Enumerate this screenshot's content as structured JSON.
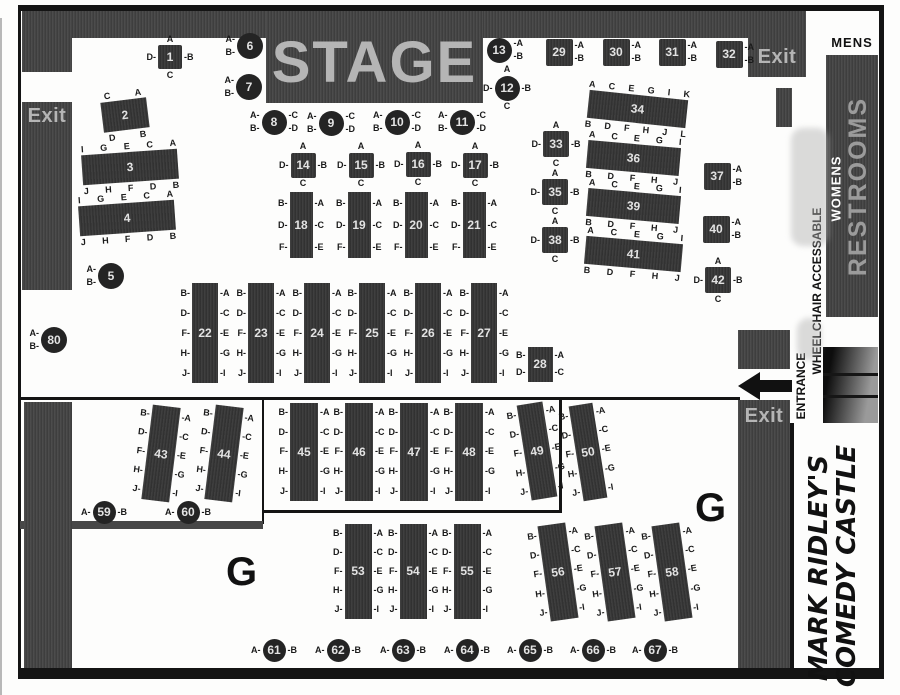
{
  "labels": {
    "stage": "STAGE",
    "exit": "Exit",
    "mens": "MENS",
    "restrooms": "RESTROOMS",
    "womens": "WOMENS",
    "entrance": "ENTRANCE",
    "wheelchair": "WHEELCHAIR ACCESSABLE",
    "g": "G",
    "logo_line1": "MARK RIDLEY'S",
    "logo_line2": "COMEDY CASTLE"
  },
  "icons": {
    "entrance_arrow": "left-arrow"
  },
  "colors": {
    "wall": "#434343",
    "table_bar": "#373737",
    "table_circle": "#242424",
    "line": "#141414",
    "stage_text": "#b5b5b5",
    "exit_text": "#b5b5b5",
    "restrooms_text": "#9b9b9b",
    "womens_text": "#ffffff",
    "seat_text": "#1a1a1a",
    "floor": "#fdfdfc"
  },
  "tables": [
    {
      "n": "1",
      "sh": "sq",
      "x": 170,
      "y": 57,
      "w": 24,
      "h": 24,
      "rot": 0,
      "T": [
        "A"
      ],
      "L": [
        "D-"
      ],
      "R": [
        "-B"
      ],
      "B": [
        "C"
      ]
    },
    {
      "n": "2",
      "sh": "bar",
      "x": 125,
      "y": 115,
      "w": 46,
      "h": 30,
      "rot": -7,
      "T": [
        "C",
        "A"
      ],
      "L": [],
      "R": [],
      "B": [
        "D",
        "B"
      ]
    },
    {
      "n": "3",
      "sh": "bar",
      "x": 130,
      "y": 167,
      "w": 96,
      "h": 30,
      "rot": -4,
      "T": [
        "I",
        "G",
        "E",
        "C",
        "A"
      ],
      "L": [],
      "R": [],
      "B": [
        "J",
        "H",
        "F",
        "D",
        "B"
      ]
    },
    {
      "n": "4",
      "sh": "bar",
      "x": 127,
      "y": 218,
      "w": 96,
      "h": 30,
      "rot": -4,
      "T": [
        "I",
        "G",
        "E",
        "C",
        "A"
      ],
      "L": [],
      "R": [],
      "B": [
        "J",
        "H",
        "F",
        "D",
        "B"
      ]
    },
    {
      "n": "5",
      "sh": "ci",
      "x": 111,
      "y": 276,
      "w": 26,
      "h": 26,
      "rot": 0,
      "T": [],
      "L": [
        "A-",
        "B-"
      ],
      "R": [],
      "B": []
    },
    {
      "n": "6",
      "sh": "ci",
      "x": 250,
      "y": 46,
      "w": 26,
      "h": 26,
      "rot": 0,
      "T": [],
      "L": [
        "A-",
        "B-"
      ],
      "R": [],
      "B": []
    },
    {
      "n": "7",
      "sh": "ci",
      "x": 249,
      "y": 87,
      "w": 26,
      "h": 26,
      "rot": 0,
      "T": [],
      "L": [
        "A-",
        "B-"
      ],
      "R": [],
      "B": []
    },
    {
      "n": "8",
      "sh": "ci",
      "x": 274,
      "y": 122,
      "w": 25,
      "h": 25,
      "rot": 0,
      "T": [],
      "L": [
        "A-",
        "B-"
      ],
      "R": [
        "-C",
        "-D"
      ],
      "B": []
    },
    {
      "n": "9",
      "sh": "ci",
      "x": 331,
      "y": 123,
      "w": 25,
      "h": 25,
      "rot": 0,
      "T": [],
      "L": [
        "A-",
        "B-"
      ],
      "R": [
        "-C",
        "-D"
      ],
      "B": []
    },
    {
      "n": "10",
      "sh": "ci",
      "x": 397,
      "y": 122,
      "w": 25,
      "h": 25,
      "rot": 0,
      "T": [],
      "L": [
        "A-",
        "B-"
      ],
      "R": [
        "-C",
        "-D"
      ],
      "B": []
    },
    {
      "n": "11",
      "sh": "ci",
      "x": 462,
      "y": 122,
      "w": 25,
      "h": 25,
      "rot": 0,
      "T": [],
      "L": [
        "A-",
        "B-"
      ],
      "R": [
        "-C",
        "-D"
      ],
      "B": []
    },
    {
      "n": "12",
      "sh": "ci",
      "x": 507,
      "y": 88,
      "w": 25,
      "h": 25,
      "rot": 0,
      "T": [
        "A"
      ],
      "L": [
        "D-"
      ],
      "R": [
        "-B"
      ],
      "B": [
        "C"
      ]
    },
    {
      "n": "13",
      "sh": "ci",
      "x": 499,
      "y": 50,
      "w": 25,
      "h": 25,
      "rot": 0,
      "T": [],
      "L": [],
      "R": [
        "-A",
        "-B"
      ],
      "B": []
    },
    {
      "n": "14",
      "sh": "sq",
      "x": 303,
      "y": 165,
      "w": 25,
      "h": 25,
      "rot": 0,
      "T": [
        "A"
      ],
      "L": [
        "D-"
      ],
      "R": [
        "-B"
      ],
      "B": [
        "C"
      ]
    },
    {
      "n": "15",
      "sh": "sq",
      "x": 361,
      "y": 165,
      "w": 25,
      "h": 25,
      "rot": 0,
      "T": [
        "A"
      ],
      "L": [
        "D-"
      ],
      "R": [
        "-B"
      ],
      "B": [
        "C"
      ]
    },
    {
      "n": "16",
      "sh": "sq",
      "x": 418,
      "y": 164,
      "w": 25,
      "h": 25,
      "rot": 0,
      "T": [
        "A"
      ],
      "L": [
        "D-"
      ],
      "R": [
        "-B"
      ],
      "B": [
        "C"
      ]
    },
    {
      "n": "17",
      "sh": "sq",
      "x": 475,
      "y": 165,
      "w": 25,
      "h": 25,
      "rot": 0,
      "T": [
        "A"
      ],
      "L": [
        "D-"
      ],
      "R": [
        "-B"
      ],
      "B": [
        "C"
      ]
    },
    {
      "n": "18",
      "sh": "bar",
      "x": 301,
      "y": 225,
      "w": 23,
      "h": 66,
      "rot": 0,
      "T": [],
      "L": [
        "B-",
        "D-",
        "F-"
      ],
      "R": [
        "-A",
        "-C",
        "-E"
      ],
      "B": []
    },
    {
      "n": "19",
      "sh": "bar",
      "x": 359,
      "y": 225,
      "w": 23,
      "h": 66,
      "rot": 0,
      "T": [],
      "L": [
        "B-",
        "D-",
        "F-"
      ],
      "R": [
        "-A",
        "-C",
        "-E"
      ],
      "B": []
    },
    {
      "n": "20",
      "sh": "bar",
      "x": 416,
      "y": 225,
      "w": 23,
      "h": 66,
      "rot": 0,
      "T": [],
      "L": [
        "B-",
        "D-",
        "F-"
      ],
      "R": [
        "-A",
        "-C",
        "-E"
      ],
      "B": []
    },
    {
      "n": "21",
      "sh": "bar",
      "x": 474,
      "y": 225,
      "w": 23,
      "h": 66,
      "rot": 0,
      "T": [],
      "L": [
        "B-",
        "D-",
        "F-"
      ],
      "R": [
        "-A",
        "-C",
        "-E"
      ],
      "B": []
    },
    {
      "n": "22",
      "sh": "bar",
      "x": 205,
      "y": 333,
      "w": 26,
      "h": 100,
      "rot": 0,
      "T": [],
      "L": [
        "B-",
        "D-",
        "F-",
        "H-",
        "J-"
      ],
      "R": [
        "-A",
        "-C",
        "-E",
        "-G",
        "-I"
      ],
      "B": []
    },
    {
      "n": "23",
      "sh": "bar",
      "x": 261,
      "y": 333,
      "w": 26,
      "h": 100,
      "rot": 0,
      "T": [],
      "L": [
        "B-",
        "D-",
        "F-",
        "H-",
        "J-"
      ],
      "R": [
        "-A",
        "-C",
        "-E",
        "-G",
        "-I"
      ],
      "B": []
    },
    {
      "n": "24",
      "sh": "bar",
      "x": 317,
      "y": 333,
      "w": 26,
      "h": 100,
      "rot": 0,
      "T": [],
      "L": [
        "B-",
        "D-",
        "F-",
        "H-",
        "J-"
      ],
      "R": [
        "-A",
        "-C",
        "-E",
        "-G",
        "-I"
      ],
      "B": []
    },
    {
      "n": "25",
      "sh": "bar",
      "x": 372,
      "y": 333,
      "w": 26,
      "h": 100,
      "rot": 0,
      "T": [],
      "L": [
        "B-",
        "D-",
        "F-",
        "H-",
        "J-"
      ],
      "R": [
        "-A",
        "-C",
        "-E",
        "-G",
        "-I"
      ],
      "B": []
    },
    {
      "n": "26",
      "sh": "bar",
      "x": 428,
      "y": 333,
      "w": 26,
      "h": 100,
      "rot": 0,
      "T": [],
      "L": [
        "B-",
        "D-",
        "F-",
        "H-",
        "J-"
      ],
      "R": [
        "-A",
        "-C",
        "-E",
        "-G",
        "-I"
      ],
      "B": []
    },
    {
      "n": "27",
      "sh": "bar",
      "x": 484,
      "y": 333,
      "w": 26,
      "h": 100,
      "rot": 0,
      "T": [],
      "L": [
        "B-",
        "D-",
        "F-",
        "H-",
        "J-"
      ],
      "R": [
        "-A",
        "-C",
        "-E",
        "-G",
        "-I"
      ],
      "B": []
    },
    {
      "n": "28",
      "sh": "bar",
      "x": 540,
      "y": 364,
      "w": 25,
      "h": 35,
      "rot": 0,
      "T": [],
      "L": [
        "B-",
        "D-"
      ],
      "R": [
        "-A",
        "-C"
      ],
      "B": []
    },
    {
      "n": "29",
      "sh": "sq",
      "x": 559,
      "y": 52,
      "w": 27,
      "h": 27,
      "rot": 0,
      "T": [],
      "L": [],
      "R": [
        "-A",
        "-B"
      ],
      "B": []
    },
    {
      "n": "30",
      "sh": "sq",
      "x": 616,
      "y": 52,
      "w": 27,
      "h": 27,
      "rot": 0,
      "T": [],
      "L": [],
      "R": [
        "-A",
        "-B"
      ],
      "B": []
    },
    {
      "n": "31",
      "sh": "sq",
      "x": 672,
      "y": 52,
      "w": 27,
      "h": 27,
      "rot": 0,
      "T": [],
      "L": [],
      "R": [
        "-A",
        "-B"
      ],
      "B": []
    },
    {
      "n": "32",
      "sh": "sq",
      "x": 729,
      "y": 54,
      "w": 27,
      "h": 27,
      "rot": 0,
      "T": [],
      "L": [],
      "R": [
        "-A",
        "-B"
      ],
      "B": []
    },
    {
      "n": "33",
      "sh": "sq",
      "x": 556,
      "y": 144,
      "w": 26,
      "h": 26,
      "rot": 0,
      "T": [
        "A"
      ],
      "L": [
        "D-"
      ],
      "R": [
        "-B"
      ],
      "B": [
        "C"
      ]
    },
    {
      "n": "34",
      "sh": "bar",
      "x": 637,
      "y": 109,
      "w": 99,
      "h": 28,
      "rot": 6,
      "T": [
        "A",
        "C",
        "E",
        "G",
        "I",
        "K"
      ],
      "L": [],
      "R": [],
      "B": [
        "B",
        "D",
        "F",
        "H",
        "J",
        "L"
      ]
    },
    {
      "n": "35",
      "sh": "sq",
      "x": 555,
      "y": 192,
      "w": 26,
      "h": 26,
      "rot": 0,
      "T": [
        "A"
      ],
      "L": [
        "D-"
      ],
      "R": [
        "-B"
      ],
      "B": [
        "C"
      ]
    },
    {
      "n": "36",
      "sh": "bar",
      "x": 633,
      "y": 158,
      "w": 93,
      "h": 28,
      "rot": 5,
      "T": [
        "A",
        "C",
        "E",
        "G",
        "I"
      ],
      "L": [],
      "R": [],
      "B": [
        "B",
        "D",
        "F",
        "H",
        "J"
      ]
    },
    {
      "n": "37",
      "sh": "sq",
      "x": 717,
      "y": 176,
      "w": 27,
      "h": 27,
      "rot": 0,
      "T": [],
      "L": [],
      "R": [
        "-A",
        "-B"
      ],
      "B": []
    },
    {
      "n": "38",
      "sh": "sq",
      "x": 555,
      "y": 240,
      "w": 26,
      "h": 26,
      "rot": 0,
      "T": [
        "A"
      ],
      "L": [
        "D-"
      ],
      "R": [
        "-B"
      ],
      "B": [
        "C"
      ]
    },
    {
      "n": "39",
      "sh": "bar",
      "x": 633,
      "y": 206,
      "w": 93,
      "h": 28,
      "rot": 5,
      "T": [
        "A",
        "C",
        "E",
        "G",
        "I"
      ],
      "L": [],
      "R": [],
      "B": [
        "B",
        "D",
        "F",
        "H",
        "J"
      ]
    },
    {
      "n": "40",
      "sh": "sq",
      "x": 716,
      "y": 229,
      "w": 27,
      "h": 27,
      "rot": 0,
      "T": [],
      "L": [],
      "R": [
        "-A",
        "-B"
      ],
      "B": []
    },
    {
      "n": "41",
      "sh": "bar",
      "x": 633,
      "y": 254,
      "w": 97,
      "h": 28,
      "rot": 5,
      "T": [
        "A",
        "C",
        "E",
        "G",
        "I"
      ],
      "L": [],
      "R": [],
      "B": [
        "B",
        "D",
        "F",
        "H",
        "J"
      ]
    },
    {
      "n": "42",
      "sh": "sq",
      "x": 718,
      "y": 280,
      "w": 26,
      "h": 26,
      "rot": 0,
      "T": [
        "A"
      ],
      "L": [
        "D-"
      ],
      "R": [
        "-B"
      ],
      "B": [
        "C"
      ]
    },
    {
      "n": "43",
      "sh": "bar",
      "x": 161,
      "y": 453,
      "w": 28,
      "h": 95,
      "rot": 7,
      "T": [],
      "L": [
        "B-",
        "D-",
        "F-",
        "H-",
        "J-"
      ],
      "R": [
        "-A",
        "-C",
        "-E",
        "-G",
        "-I"
      ],
      "B": []
    },
    {
      "n": "44",
      "sh": "bar",
      "x": 224,
      "y": 453,
      "w": 28,
      "h": 95,
      "rot": 7,
      "T": [],
      "L": [
        "B-",
        "D-",
        "F-",
        "H-",
        "J-"
      ],
      "R": [
        "-A",
        "-C",
        "-E",
        "-G",
        "-I"
      ],
      "B": []
    },
    {
      "n": "45",
      "sh": "bar",
      "x": 304,
      "y": 452,
      "w": 28,
      "h": 98,
      "rot": 0,
      "T": [],
      "L": [
        "B-",
        "D-",
        "F-",
        "H-",
        "J-"
      ],
      "R": [
        "-A",
        "-C",
        "-E",
        "-G",
        "-I"
      ],
      "B": []
    },
    {
      "n": "46",
      "sh": "bar",
      "x": 359,
      "y": 452,
      "w": 28,
      "h": 98,
      "rot": 0,
      "T": [],
      "L": [
        "B-",
        "D-",
        "F-",
        "H-",
        "J-"
      ],
      "R": [
        "-A",
        "-C",
        "-E",
        "-G",
        "-I"
      ],
      "B": []
    },
    {
      "n": "47",
      "sh": "bar",
      "x": 414,
      "y": 452,
      "w": 28,
      "h": 98,
      "rot": 0,
      "T": [],
      "L": [
        "B-",
        "D-",
        "F-",
        "H-",
        "J-"
      ],
      "R": [
        "-A",
        "-C",
        "-E",
        "-G",
        "-I"
      ],
      "B": []
    },
    {
      "n": "48",
      "sh": "bar",
      "x": 469,
      "y": 452,
      "w": 28,
      "h": 98,
      "rot": 0,
      "T": [],
      "L": [
        "B-",
        "D-",
        "F-",
        "H-",
        "J-"
      ],
      "R": [
        "-A",
        "-C",
        "-E",
        "-G",
        "-I"
      ],
      "B": []
    },
    {
      "n": "49",
      "sh": "bar",
      "x": 537,
      "y": 451,
      "w": 26,
      "h": 96,
      "rot": -9,
      "T": [],
      "L": [
        "B-",
        "D-",
        "F-",
        "H-",
        "J-"
      ],
      "R": [
        "-A",
        "-C",
        "-E",
        "-G",
        "-I"
      ],
      "B": []
    },
    {
      "n": "50",
      "sh": "bar",
      "x": 588,
      "y": 452,
      "w": 24,
      "h": 96,
      "rot": -9,
      "T": [],
      "L": [
        "B-",
        "D-",
        "F-",
        "H-",
        "J-"
      ],
      "R": [
        "-A",
        "-C",
        "-E",
        "-G",
        "-I"
      ],
      "B": []
    },
    {
      "n": "53",
      "sh": "bar",
      "x": 358,
      "y": 571,
      "w": 27,
      "h": 95,
      "rot": 0,
      "T": [],
      "L": [
        "B-",
        "D-",
        "F-",
        "H-",
        "J-"
      ],
      "R": [
        "-A",
        "-C",
        "-E",
        "-G",
        "-I"
      ],
      "B": []
    },
    {
      "n": "54",
      "sh": "bar",
      "x": 413,
      "y": 571,
      "w": 27,
      "h": 95,
      "rot": 0,
      "T": [],
      "L": [
        "B-",
        "D-",
        "F-",
        "H-",
        "J-"
      ],
      "R": [
        "-A",
        "-C",
        "-E",
        "-G",
        "-I"
      ],
      "B": []
    },
    {
      "n": "55",
      "sh": "bar",
      "x": 467,
      "y": 571,
      "w": 27,
      "h": 95,
      "rot": 0,
      "T": [],
      "L": [
        "B-",
        "D-",
        "F-",
        "H-",
        "J-"
      ],
      "R": [
        "-A",
        "-C",
        "-E",
        "-G",
        "-I"
      ],
      "B": []
    },
    {
      "n": "56",
      "sh": "bar",
      "x": 558,
      "y": 572,
      "w": 28,
      "h": 96,
      "rot": -8,
      "T": [],
      "L": [
        "B-",
        "D-",
        "F-",
        "H-",
        "J-"
      ],
      "R": [
        "-A",
        "-C",
        "-E",
        "-G",
        "-I"
      ],
      "B": []
    },
    {
      "n": "57",
      "sh": "bar",
      "x": 615,
      "y": 572,
      "w": 28,
      "h": 96,
      "rot": -8,
      "T": [],
      "L": [
        "B-",
        "D-",
        "F-",
        "H-",
        "J-"
      ],
      "R": [
        "-A",
        "-C",
        "-E",
        "-G",
        "-I"
      ],
      "B": []
    },
    {
      "n": "58",
      "sh": "bar",
      "x": 672,
      "y": 572,
      "w": 28,
      "h": 96,
      "rot": -8,
      "T": [],
      "L": [
        "B-",
        "D-",
        "F-",
        "H-",
        "J-"
      ],
      "R": [
        "-A",
        "-C",
        "-E",
        "-G",
        "-I"
      ],
      "B": []
    },
    {
      "n": "59",
      "sh": "ci",
      "x": 104,
      "y": 512,
      "w": 23,
      "h": 23,
      "rot": 0,
      "T": [],
      "L": [
        "A-"
      ],
      "R": [
        "-B"
      ],
      "B": []
    },
    {
      "n": "60",
      "sh": "ci",
      "x": 188,
      "y": 512,
      "w": 23,
      "h": 23,
      "rot": 0,
      "T": [],
      "L": [
        "A-"
      ],
      "R": [
        "-B"
      ],
      "B": []
    },
    {
      "n": "61",
      "sh": "ci",
      "x": 274,
      "y": 650,
      "w": 23,
      "h": 23,
      "rot": 0,
      "T": [],
      "L": [
        "A-"
      ],
      "R": [
        "-B"
      ],
      "B": []
    },
    {
      "n": "62",
      "sh": "ci",
      "x": 338,
      "y": 650,
      "w": 23,
      "h": 23,
      "rot": 0,
      "T": [],
      "L": [
        "A-"
      ],
      "R": [
        "-B"
      ],
      "B": []
    },
    {
      "n": "63",
      "sh": "ci",
      "x": 403,
      "y": 650,
      "w": 23,
      "h": 23,
      "rot": 0,
      "T": [],
      "L": [
        "A-"
      ],
      "R": [
        "-B"
      ],
      "B": []
    },
    {
      "n": "64",
      "sh": "ci",
      "x": 467,
      "y": 650,
      "w": 23,
      "h": 23,
      "rot": 0,
      "T": [],
      "L": [
        "A-"
      ],
      "R": [
        "-B"
      ],
      "B": []
    },
    {
      "n": "65",
      "sh": "ci",
      "x": 530,
      "y": 650,
      "w": 23,
      "h": 23,
      "rot": 0,
      "T": [],
      "L": [
        "A-"
      ],
      "R": [
        "-B"
      ],
      "B": []
    },
    {
      "n": "66",
      "sh": "ci",
      "x": 593,
      "y": 650,
      "w": 23,
      "h": 23,
      "rot": 0,
      "T": [],
      "L": [
        "A-"
      ],
      "R": [
        "-B"
      ],
      "B": []
    },
    {
      "n": "67",
      "sh": "ci",
      "x": 655,
      "y": 650,
      "w": 23,
      "h": 23,
      "rot": 0,
      "T": [],
      "L": [
        "A-"
      ],
      "R": [
        "-B"
      ],
      "B": []
    },
    {
      "n": "80",
      "sh": "ci",
      "x": 54,
      "y": 340,
      "w": 26,
      "h": 26,
      "rot": 0,
      "T": [],
      "L": [
        "A-",
        "B-"
      ],
      "R": [],
      "B": []
    }
  ]
}
